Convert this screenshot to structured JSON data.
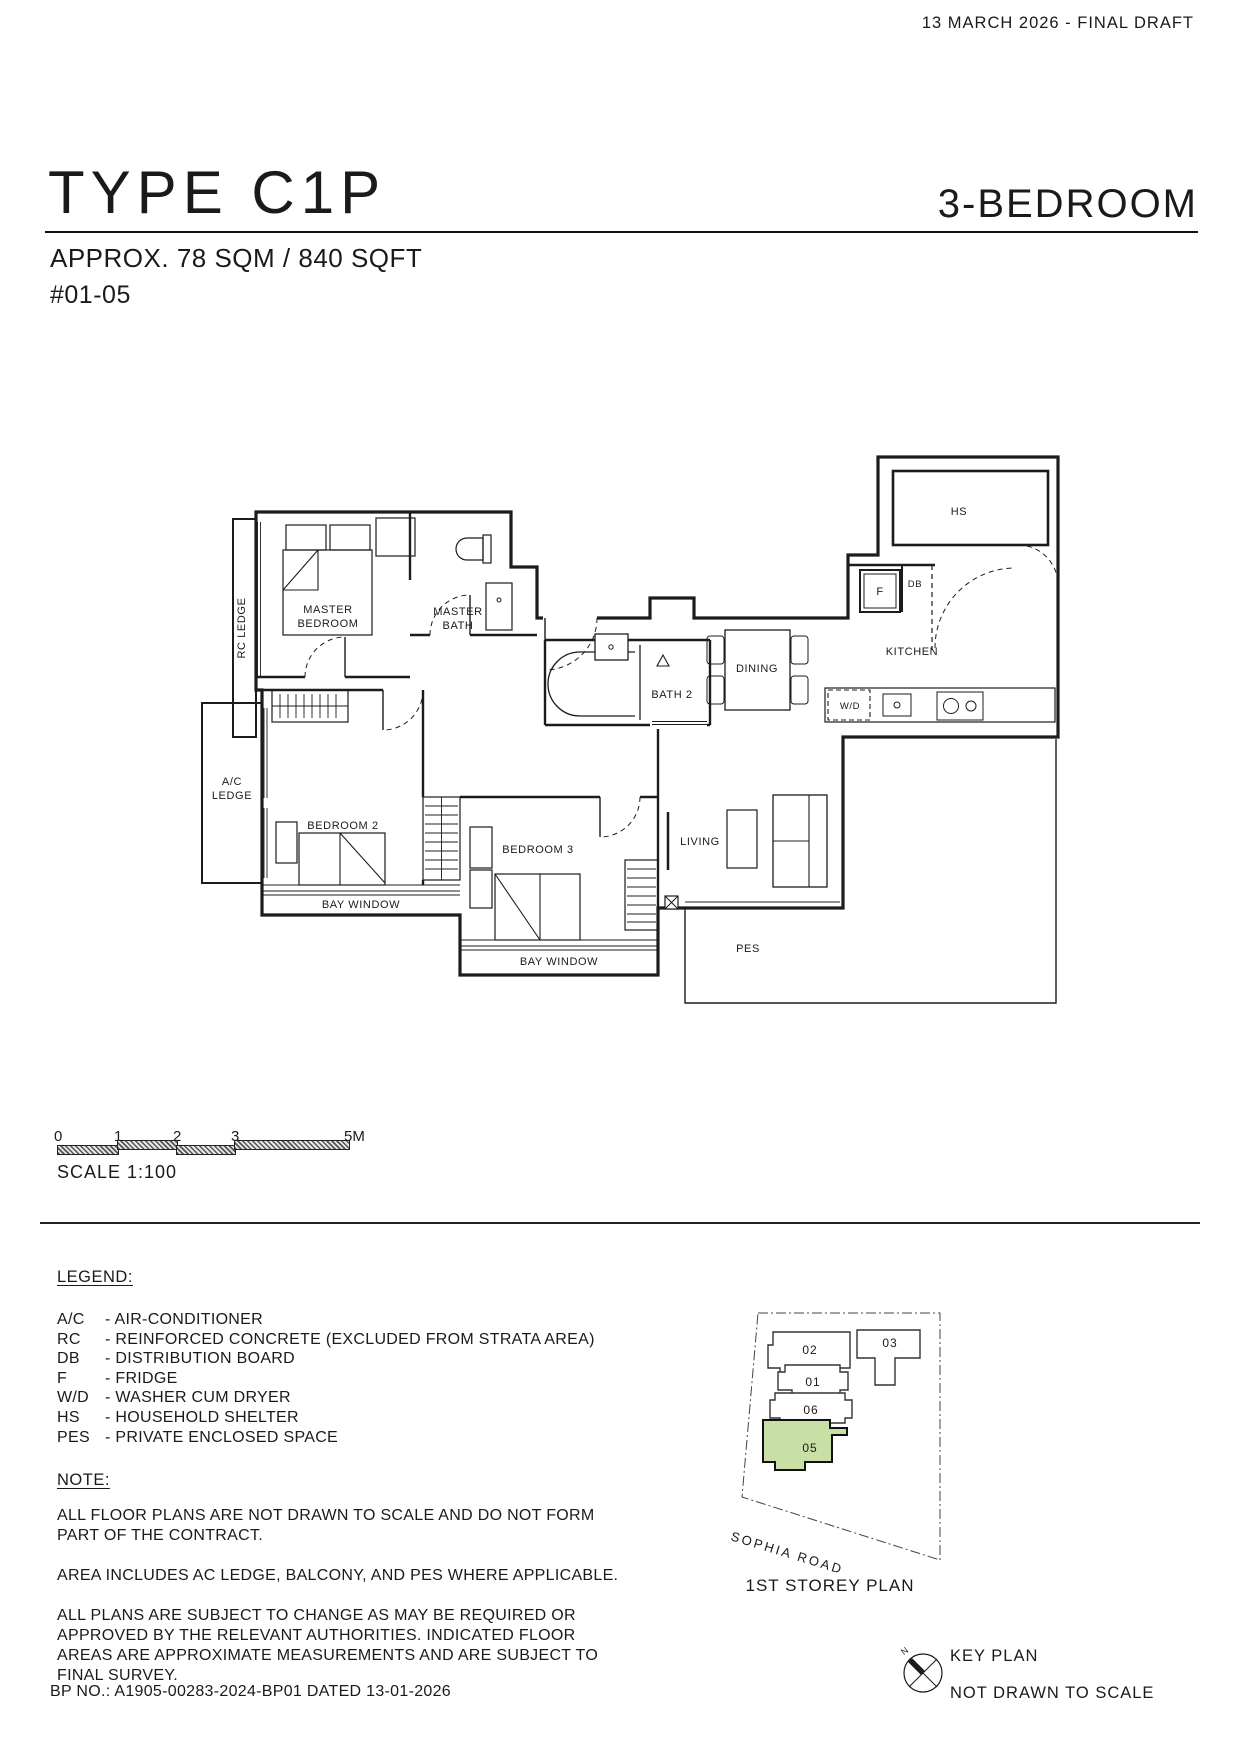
{
  "header": {
    "draft_note": "13 MARCH 2026 - FINAL DRAFT"
  },
  "title": {
    "type_name": "TYPE C1P",
    "bedroom_label": "3-BEDROOM",
    "area": "APPROX. 78 SQM / 840 SQFT",
    "unit_no": "#01-05"
  },
  "floor_plan": {
    "rooms": {
      "rc_ledge": "RC LEDGE",
      "master_bedroom": [
        "MASTER",
        "BEDROOM"
      ],
      "master_bath": [
        "MASTER",
        "BATH"
      ],
      "bath_2": "BATH 2",
      "dining": "DINING",
      "kitchen": "KITCHEN",
      "household_shelter": "HS",
      "fridge": "F",
      "distribution_board": "DB",
      "washer_dryer": "W/D",
      "ac_ledge": [
        "A/C",
        "LEDGE"
      ],
      "bedroom_2": "BEDROOM 2",
      "bedroom_3": "BEDROOM 3",
      "bay_window": "BAY WINDOW",
      "living": "LIVING",
      "pes": "PES"
    }
  },
  "scale_bar": {
    "ticks": [
      "0",
      "1",
      "2",
      "3",
      "5M"
    ],
    "label": "SCALE 1:100"
  },
  "legend": {
    "heading": "LEGEND:",
    "items": [
      {
        "abbr": "A/C",
        "desc": "- AIR-CONDITIONER"
      },
      {
        "abbr": "RC",
        "desc": "- REINFORCED CONCRETE (EXCLUDED FROM STRATA AREA)"
      },
      {
        "abbr": "DB",
        "desc": "- DISTRIBUTION BOARD"
      },
      {
        "abbr": "F",
        "desc": "- FRIDGE"
      },
      {
        "abbr": "W/D",
        "desc": "- WASHER CUM DRYER"
      },
      {
        "abbr": "HS",
        "desc": "- HOUSEHOLD SHELTER"
      },
      {
        "abbr": "PES",
        "desc": "- PRIVATE ENCLOSED SPACE"
      }
    ]
  },
  "note": {
    "heading": "NOTE:",
    "paragraphs": [
      "ALL FLOOR PLANS ARE NOT DRAWN TO SCALE AND DO NOT FORM PART OF THE CONTRACT.",
      "AREA INCLUDES AC LEDGE, BALCONY, AND PES WHERE APPLICABLE.",
      "ALL PLANS ARE SUBJECT TO CHANGE AS MAY BE REQUIRED OR APPROVED BY THE RELEVANT AUTHORITIES. INDICATED FLOOR AREAS ARE APPROXIMATE MEASUREMENTS AND ARE SUBJECT TO FINAL SURVEY."
    ]
  },
  "bp_line": "BP NO.: A1905-00283-2024-BP01 DATED 13-01-2026",
  "key_plan": {
    "units": [
      {
        "id": "02"
      },
      {
        "id": "03"
      },
      {
        "id": "01"
      },
      {
        "id": "06"
      },
      {
        "id": "05"
      }
    ],
    "highlighted_unit": "05",
    "highlight_color": "#c8e0a6",
    "road": "SOPHIA ROAD",
    "caption": "1ST STOREY PLAN",
    "title": "KEY PLAN",
    "scale_note": "NOT DRAWN TO SCALE",
    "north_label": "N"
  }
}
